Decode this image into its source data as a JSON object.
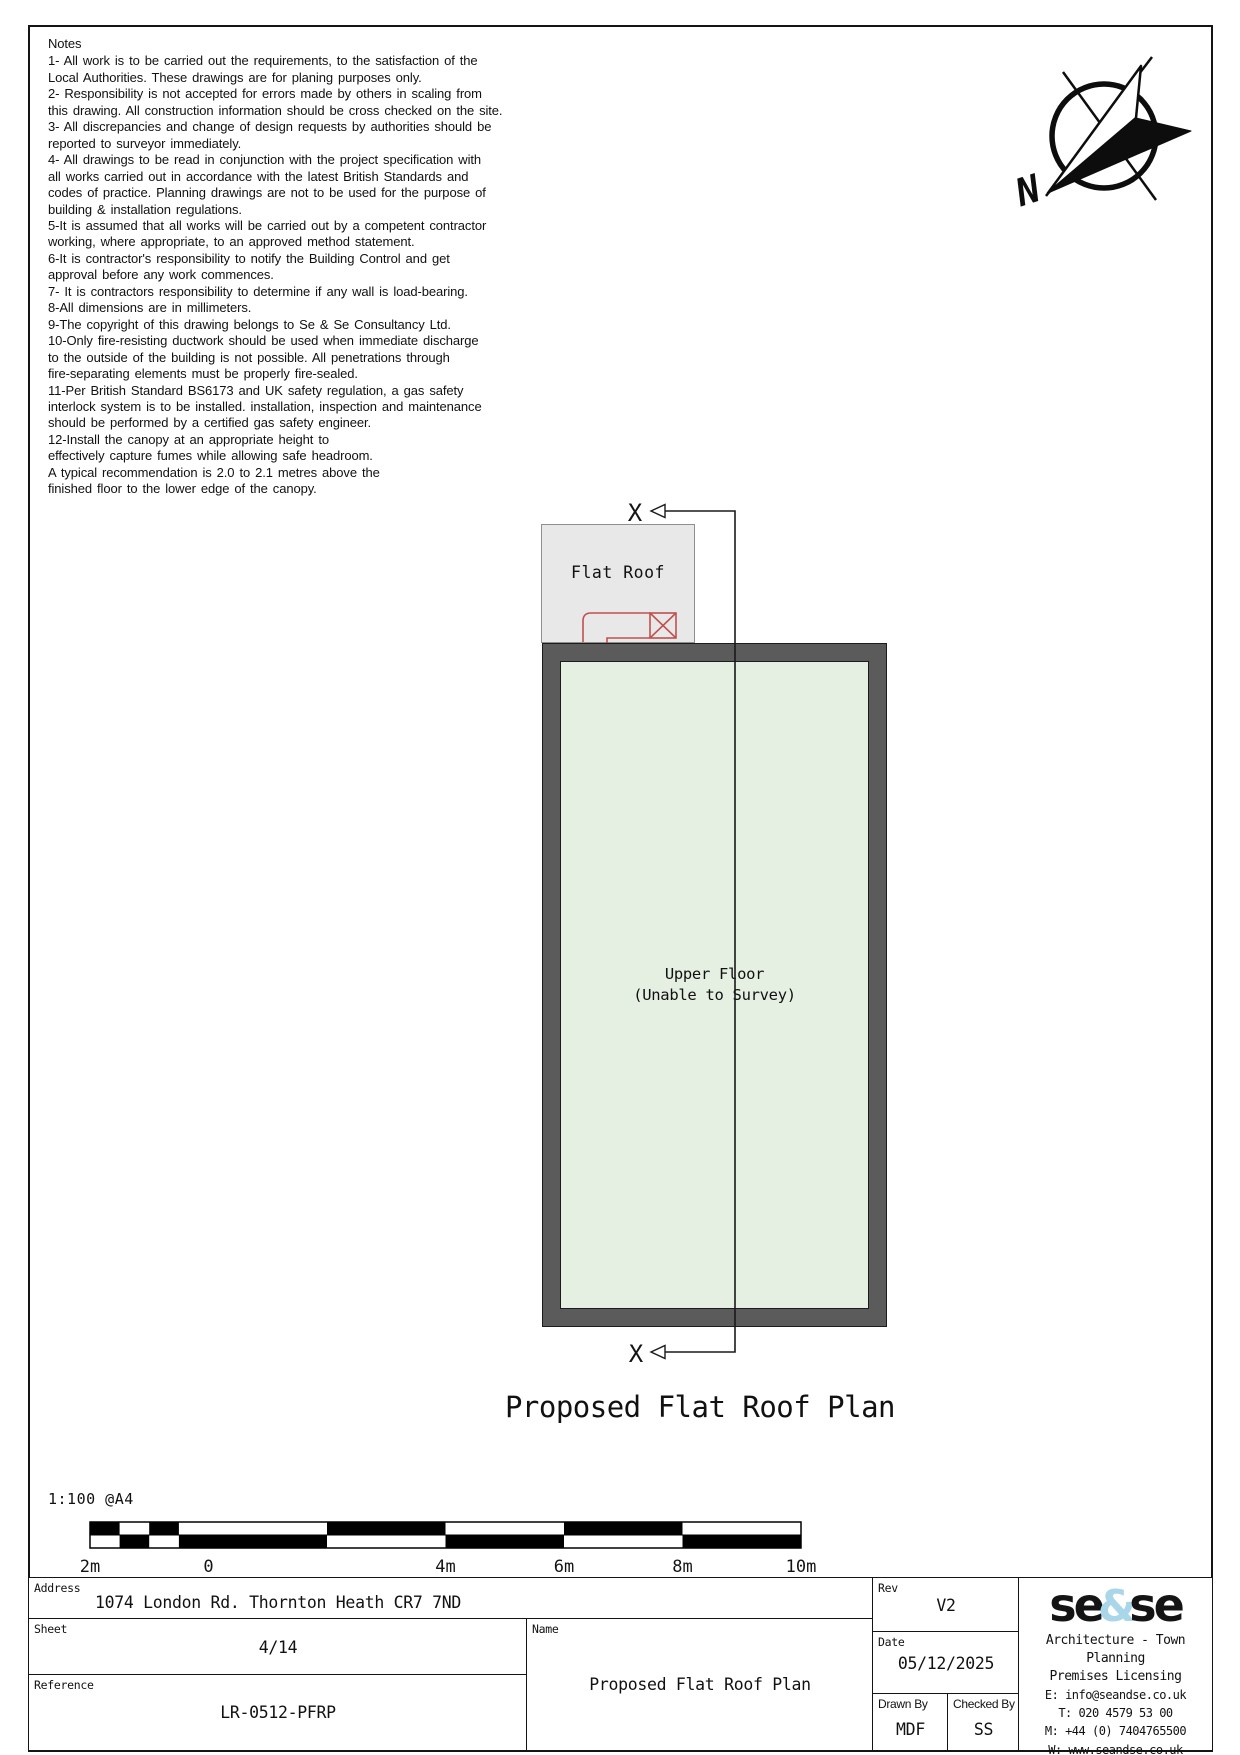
{
  "notes": {
    "title": "Notes",
    "body": "1- All work is to be carried out the requirements, to the satisfaction of the\nLocal Authorities. These drawings are for planing purposes only.\n2- Responsibility is not accepted for errors made by others in scaling from\nthis drawing. All construction information should be cross checked on the site.\n3- All discrepancies and change of design requests by authorities should be\nreported to surveyor immediately.\n4- All drawings to be read in conjunction with the project specification with\nall works carried out in accordance with the latest British Standards and\ncodes of practice. Planning drawings are not to be used for the purpose of\nbuilding & installation regulations.\n5-It is assumed that all works will be carried out by a competent contractor\nworking, where appropriate, to an approved method statement.\n6-It is contractor's responsibility to notify the Building Control and get\napproval before any work commences.\n7- It is contractors responsibility to determine if any wall is load-bearing.\n8-All dimensions are in millimeters.\n9-The copyright of this drawing belongs to Se & Se Consultancy Ltd.\n10-Only fire-resisting ductwork should be used when immediate discharge\nto the outside of the building is not possible. All penetrations through\nfire-separating elements must be properly fire-sealed.\n11-Per British Standard BS6173 and UK safety regulation, a gas safety\ninterlock system is to be installed. installation, inspection and maintenance\nshould be performed by a certified gas safety engineer.\n12-Install the canopy at an appropriate height to\neffectively capture fumes while allowing safe headroom.\nA typical recommendation is 2.0 to 2.1 metres above the\nfinished floor to the lower edge of the canopy."
  },
  "north": {
    "label": "N"
  },
  "plan": {
    "flat_roof_label": "Flat Roof",
    "upper_floor_label": "Upper Floor",
    "upper_floor_sub": "(Unable to Survey)",
    "section_marker_top": "X",
    "section_marker_bottom": "X",
    "title": "Proposed Flat Roof Plan"
  },
  "scale": {
    "ratio": "1:100 @A4",
    "labels": [
      "2m",
      "0",
      "4m",
      "6m",
      "8m",
      "10m"
    ]
  },
  "titleblock": {
    "address_label": "Address",
    "address": "1074 London Rd. Thornton Heath CR7 7ND",
    "sheet_label": "Sheet",
    "sheet": "4/14",
    "reference_label": "Reference",
    "reference": "LR-0512-PFRP",
    "name_label": "Name",
    "name": "Proposed Flat Roof Plan",
    "rev_label": "Rev",
    "rev": "V2",
    "date_label": "Date",
    "date": "05/12/2025",
    "drawn_label": "Drawn By",
    "drawn": "MDF",
    "checked_label": "Checked By",
    "checked": "SS",
    "logo": {
      "part1": "se",
      "amp": "&",
      "part2": "se",
      "tagline1": "Architecture - Town Planning",
      "tagline2": "Premises Licensing",
      "email": "E: info@seandse.co.uk",
      "tel": "T: 020 4579 53 00",
      "mobile": "M: +44 (0) 7404765500",
      "web": "W: www.seandse.co.uk"
    }
  },
  "colors": {
    "wall_gray": "#5b5b5b",
    "interior_green": "#e5efe2",
    "flat_roof_gray": "#e8e8e8",
    "canopy_red": "#c0504d",
    "logo_blue": "#a9d6e8",
    "line_black": "#141414"
  }
}
